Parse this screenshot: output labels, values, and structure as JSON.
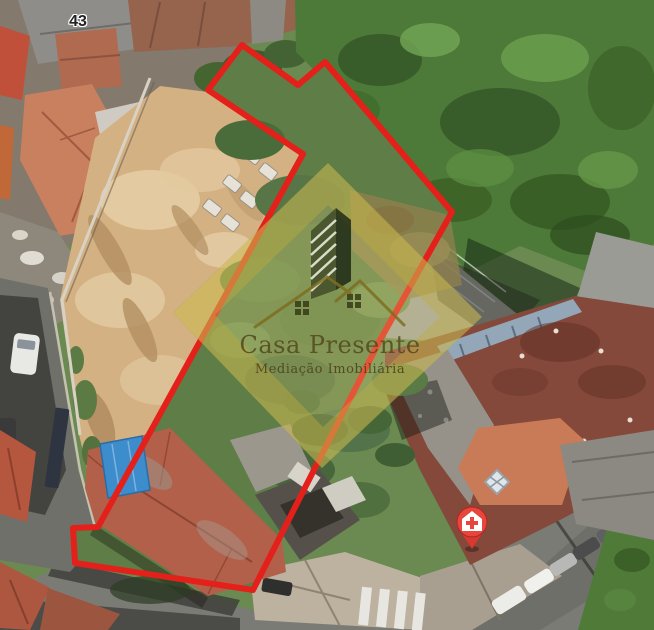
{
  "image": {
    "type": "aerial-satellite-photo",
    "street_number_label": "43"
  },
  "watermark": {
    "brand": "Casa Presente",
    "tagline": "Mediação Imobiliária"
  },
  "annotations": {
    "boundary_color": "#e4201a",
    "pin_color": "#e8453c",
    "pin_icon": "medical-cross-house-pin"
  }
}
